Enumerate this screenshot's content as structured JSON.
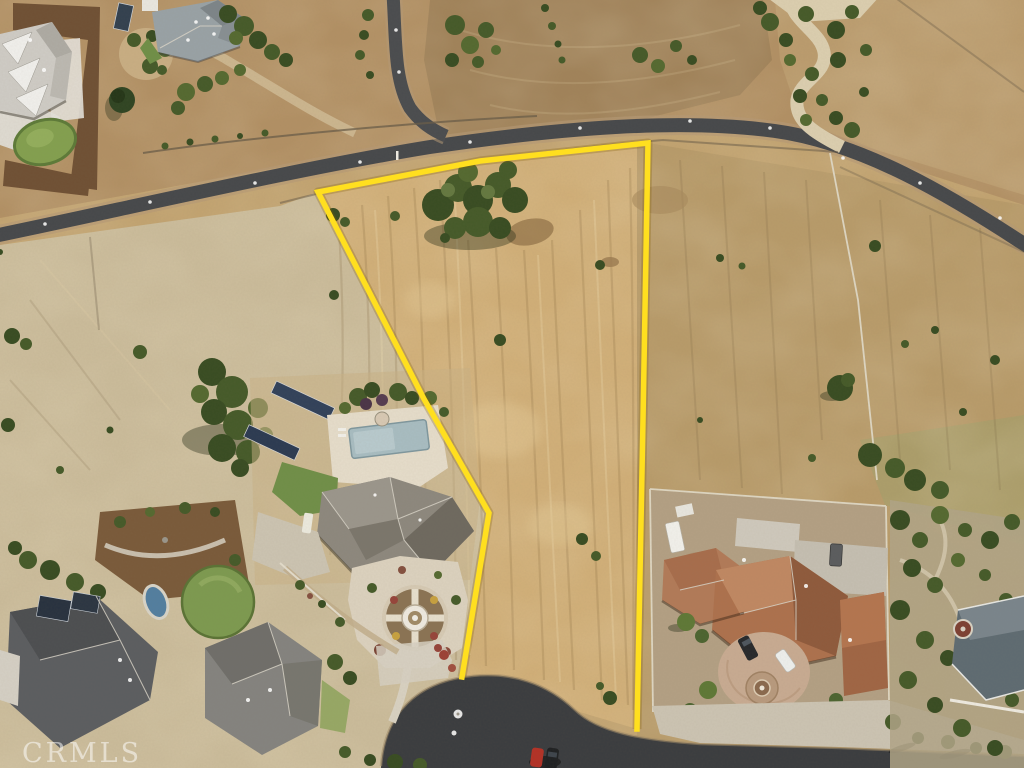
{
  "scene": {
    "description": "Aerial drone photograph of a vacant land parcel outlined in yellow, fronting a cul-de-sac street and a curving country road, surrounded by large estate homes, solar arrays, pools and dry golden grass fields.",
    "watermark": "CRMLS"
  },
  "parcel_boundary": {
    "points": "462,677 489,513 424,399 318,192 480,161 648,143 643,420 637,729",
    "color": "#ffdf1f",
    "halo_color": "rgba(130,95,0,0.28)",
    "stroke_width": "5.5"
  },
  "palette": {
    "dry_grass": "#c2a370",
    "parcel_grass": "#d1af78",
    "pale_grass": "#cbbc9b",
    "dirt_field": "#a1835a",
    "asphalt": "#46484b",
    "cul_de_sac_asphalt": "#3a3c3f",
    "gravel_path": "#dccfb0",
    "tree_dark": "#384c22",
    "lawn_green": "#7d9a50",
    "lap_pool": "#a8bdc2",
    "plunge_pool": "#527ea0",
    "terracotta_roof": "#ad714d",
    "gray_roof": "#8d887e",
    "dark_roof": "#5b5d60",
    "white_roof": "#eceae6",
    "blue_gray_roof": "#99a2a6",
    "mulch": "#6f5034",
    "solar_panel": "#2e3c50",
    "fence_white": "#e6e0d2",
    "concrete": "#d6d0c2",
    "suv_dark": "#26282b",
    "car_white": "#eef0ee",
    "car_red": "#b33126"
  }
}
